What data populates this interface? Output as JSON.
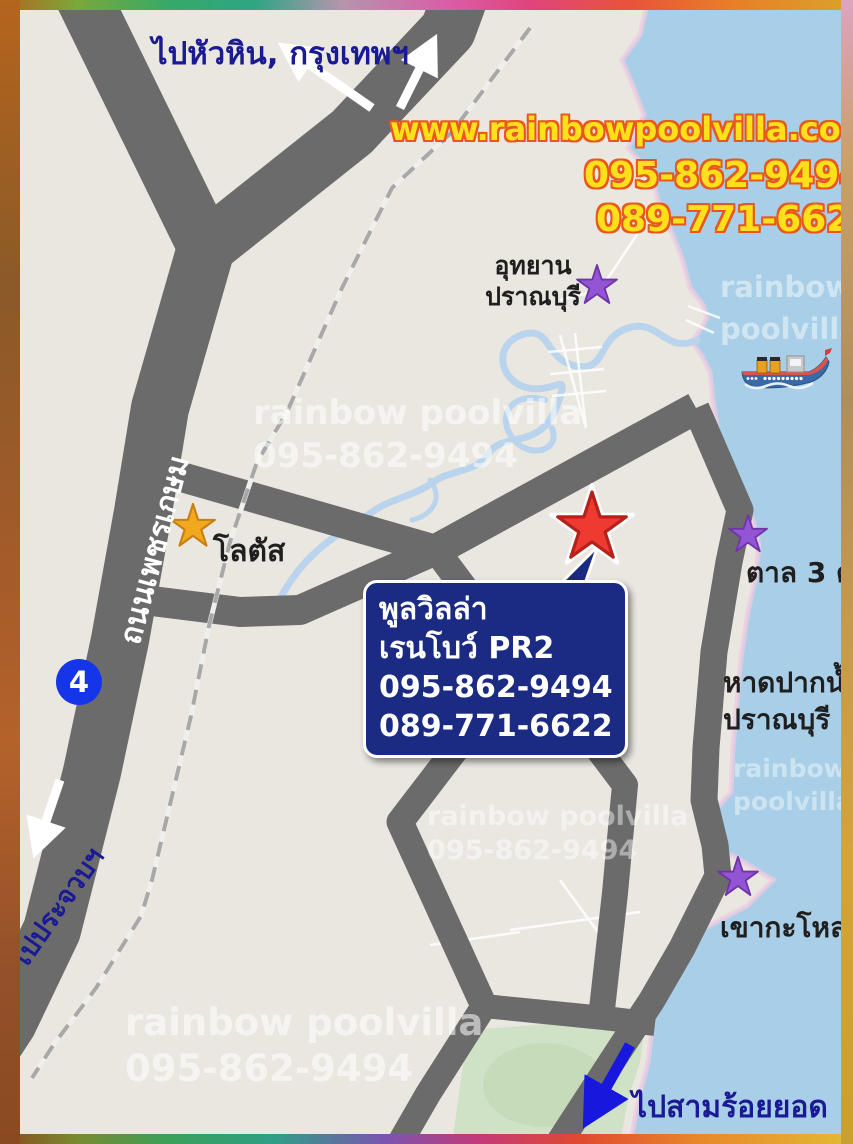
{
  "title": "Rainbow Pool Villa PR2 location map",
  "colors": {
    "land": "#eae7e1",
    "sea": "#a8cfe7",
    "beach_fringe": "#eecbe2",
    "road": "#6b6b6b",
    "river": "#b9d4ec",
    "green_area": "#cfe2c6",
    "railway": "#a8a8a8",
    "navy_text": "#1a1a94",
    "yellow_text": "#ffe01a",
    "yellow_outline": "#e8581e",
    "callout_bg": "#1b2a82",
    "callout_text": "#ffffff",
    "star_red": "#ee3a30",
    "star_red_stroke": "#b5221a",
    "star_purple": "#9355d4",
    "star_purple_stroke": "#6e35a8",
    "star_orange": "#f2a71f",
    "star_orange_stroke": "#c77f12",
    "route_badge": "#1535e8",
    "arrow_white": "#ffffff",
    "arrow_blue": "#1717dd",
    "watermark": "rgba(255,255,255,0.55)"
  },
  "labels": {
    "to_huahin_bangkok": "ไปหัวหิน, กรุงเทพฯ",
    "pranburi_park_line1": "อุทยาน",
    "pranburi_park_line2": "ปราณบุรี",
    "lotus": "โลตัส",
    "phetkasem_road": "ถนนเพชรเกษม",
    "to_prachuap": "ไปประจวบฯ",
    "tan_3_ton": "ตาล 3 ต้น",
    "pak_nam_pran_line1": "หาดปากน้ำ",
    "pak_nam_pran_line2": "ปราณบุรี",
    "khao_kalok": "เขากะโหลก",
    "to_sam_roi_yot": "ไปสามร้อยยอด"
  },
  "contact": {
    "website": "www.rainbowpoolvilla.com",
    "phone1": "095-862-9494",
    "phone2": "089-771-6622"
  },
  "callout": {
    "line1": "พูลวิลล่า",
    "line2": "เรนโบว์ PR2",
    "line3": "095-862-9494",
    "line4": "089-771-6622"
  },
  "route_badge": "4",
  "watermark": {
    "line1": "rainbow poolvilla",
    "line2": "095-862-9494",
    "word1": "rainbow",
    "word2": "poolvilla"
  }
}
